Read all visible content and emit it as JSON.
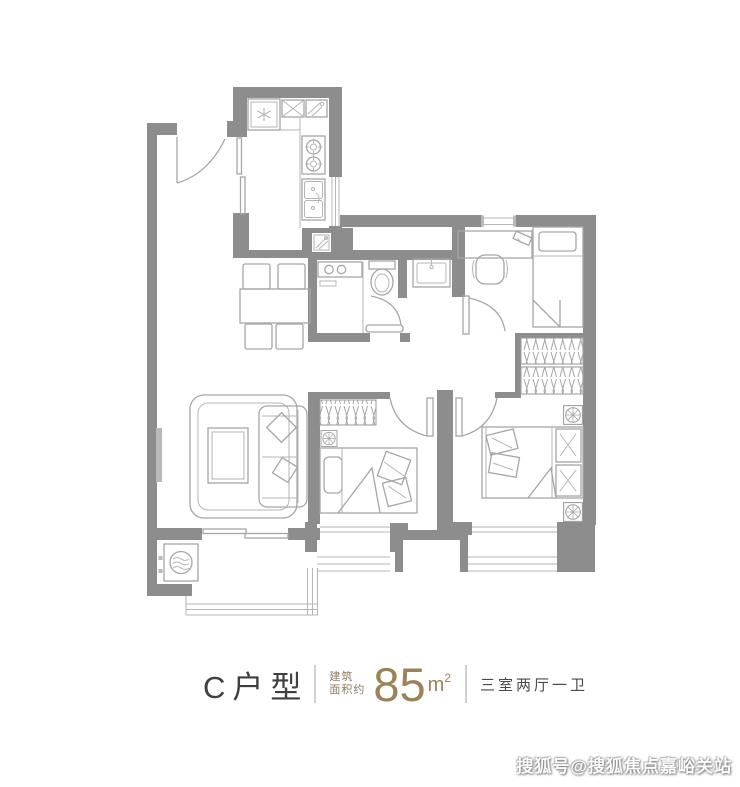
{
  "colors": {
    "wall": "#8d8d8d",
    "line": "#a6a6a6",
    "thin": "#b5b5b5",
    "accent": "#9c8357",
    "text": "#3f3f3f",
    "divider": "#cfcfcf"
  },
  "footer": {
    "unit_name": "C户型",
    "area_label_line1": "建筑",
    "area_label_line2": "面积约",
    "area_value": "85",
    "area_unit": "m",
    "area_unit_sup": "2",
    "layout_description": "三室两厅一卫"
  },
  "watermark": {
    "text": "搜狐号@搜狐焦点嘉峪关站"
  }
}
